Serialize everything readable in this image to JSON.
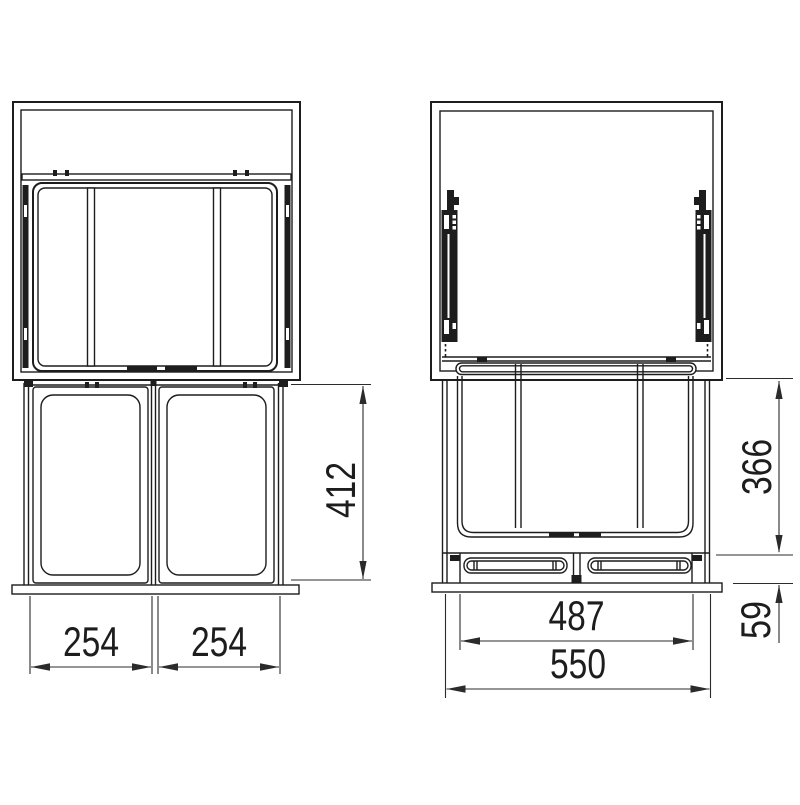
{
  "page": {
    "title": "Built-in pull-out waste sorter — installation drawing",
    "background": "#ffffff"
  },
  "drawing": {
    "type": "technical-drawing",
    "views": [
      "front-view",
      "side-view"
    ],
    "line_color": "#1d1d1d",
    "dim_color": "#2b2b2b",
    "dimensions": {
      "front_bin_left_width": "254",
      "front_bin_right_width": "254",
      "front_unit_height": "412",
      "side_unit_height": "366",
      "side_base_height": "59",
      "side_inner_depth": "487",
      "side_total_depth": "550"
    }
  }
}
